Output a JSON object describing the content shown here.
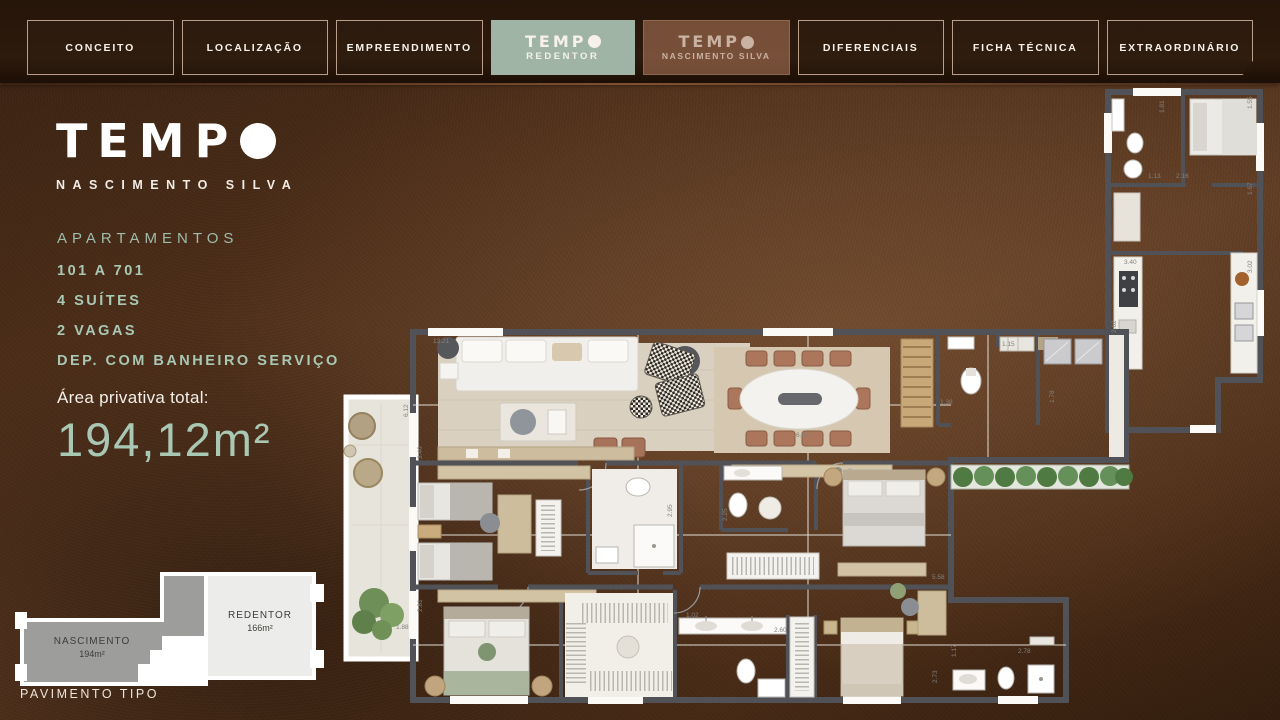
{
  "colors": {
    "accent_green": "#a9c8b4",
    "tab_active_bg": "#9fb4a4",
    "background_brown": "#4c2e19",
    "plan_wall": "#515257",
    "plan_floor": "#edeae3"
  },
  "nav": {
    "tabs": [
      {
        "label": "CONCEITO",
        "state": "normal"
      },
      {
        "label": "LOCALIZAÇÃO",
        "state": "normal"
      },
      {
        "label": "EMPREENDIMENTO",
        "state": "normal"
      },
      {
        "logo": "TEMP",
        "sub": "REDENTOR",
        "state": "active"
      },
      {
        "logo": "TEMP",
        "sub": "NASCIMENTO SILVA",
        "state": "dimmed"
      },
      {
        "label": "DIFERENCIAIS",
        "state": "normal"
      },
      {
        "label": "FICHA TÉCNICA",
        "state": "normal"
      },
      {
        "label": "EXTRAORDINÁRIO",
        "state": "normal"
      }
    ]
  },
  "sidebar": {
    "logo_word": "TEMP",
    "logo_sub": "NASCIMENTO SILVA",
    "section_label": "APARTAMENTOS",
    "details": [
      "101 A 701",
      "4 SUÍTES",
      "2 VAGAS",
      "DEP. COM BANHEIRO SERVIÇO"
    ],
    "area_label": "Área privativa total:",
    "area_value": "194,12m²"
  },
  "mini_plan": {
    "left_name": "NASCIMENTO",
    "left_area": "194m²",
    "right_name": "REDENTOR",
    "right_area": "166m²",
    "caption": "PAVIMENTO TIPO"
  },
  "floor_plan": {
    "dimensions": [
      {
        "t": "13.21",
        "x": 95,
        "y": 258,
        "r": 0
      },
      {
        "t": "6.12",
        "x": 70,
        "y": 332,
        "r": -90
      },
      {
        "t": "3.40",
        "x": 84,
        "y": 374,
        "r": -90
      },
      {
        "t": "2.81",
        "x": 84,
        "y": 527,
        "r": -90
      },
      {
        "t": "1.88",
        "x": 58,
        "y": 544,
        "r": 0
      },
      {
        "t": "6.54",
        "x": 458,
        "y": 352,
        "r": 0
      },
      {
        "t": "2.95",
        "x": 334,
        "y": 432,
        "r": -90
      },
      {
        "t": "2.25",
        "x": 389,
        "y": 436,
        "r": -90
      },
      {
        "t": "5.58",
        "x": 594,
        "y": 494,
        "r": 0
      },
      {
        "t": "1.02",
        "x": 348,
        "y": 532,
        "r": 0
      },
      {
        "t": "2.60",
        "x": 436,
        "y": 547,
        "r": 0
      },
      {
        "t": "2.78",
        "x": 680,
        "y": 568,
        "r": 0
      },
      {
        "t": "1.17",
        "x": 618,
        "y": 572,
        "r": -90
      },
      {
        "t": "2.73",
        "x": 599,
        "y": 598,
        "r": -90
      },
      {
        "t": "1.38",
        "x": 602,
        "y": 319,
        "r": 0
      },
      {
        "t": "1.15",
        "x": 664,
        "y": 261,
        "r": 0
      },
      {
        "t": "1.78",
        "x": 716,
        "y": 318,
        "r": -90
      },
      {
        "t": "1.81",
        "x": 826,
        "y": 28,
        "r": -90
      },
      {
        "t": "1.55",
        "x": 914,
        "y": 24,
        "r": -90
      },
      {
        "t": "1.13",
        "x": 810,
        "y": 93,
        "r": 0
      },
      {
        "t": "2.16",
        "x": 838,
        "y": 93,
        "r": 0
      },
      {
        "t": "1.67",
        "x": 914,
        "y": 110,
        "r": -90
      },
      {
        "t": "3.40",
        "x": 786,
        "y": 179,
        "r": 0
      },
      {
        "t": "3.02",
        "x": 914,
        "y": 188,
        "r": -90
      },
      {
        "t": "2.62",
        "x": 778,
        "y": 248,
        "r": -90
      }
    ]
  }
}
